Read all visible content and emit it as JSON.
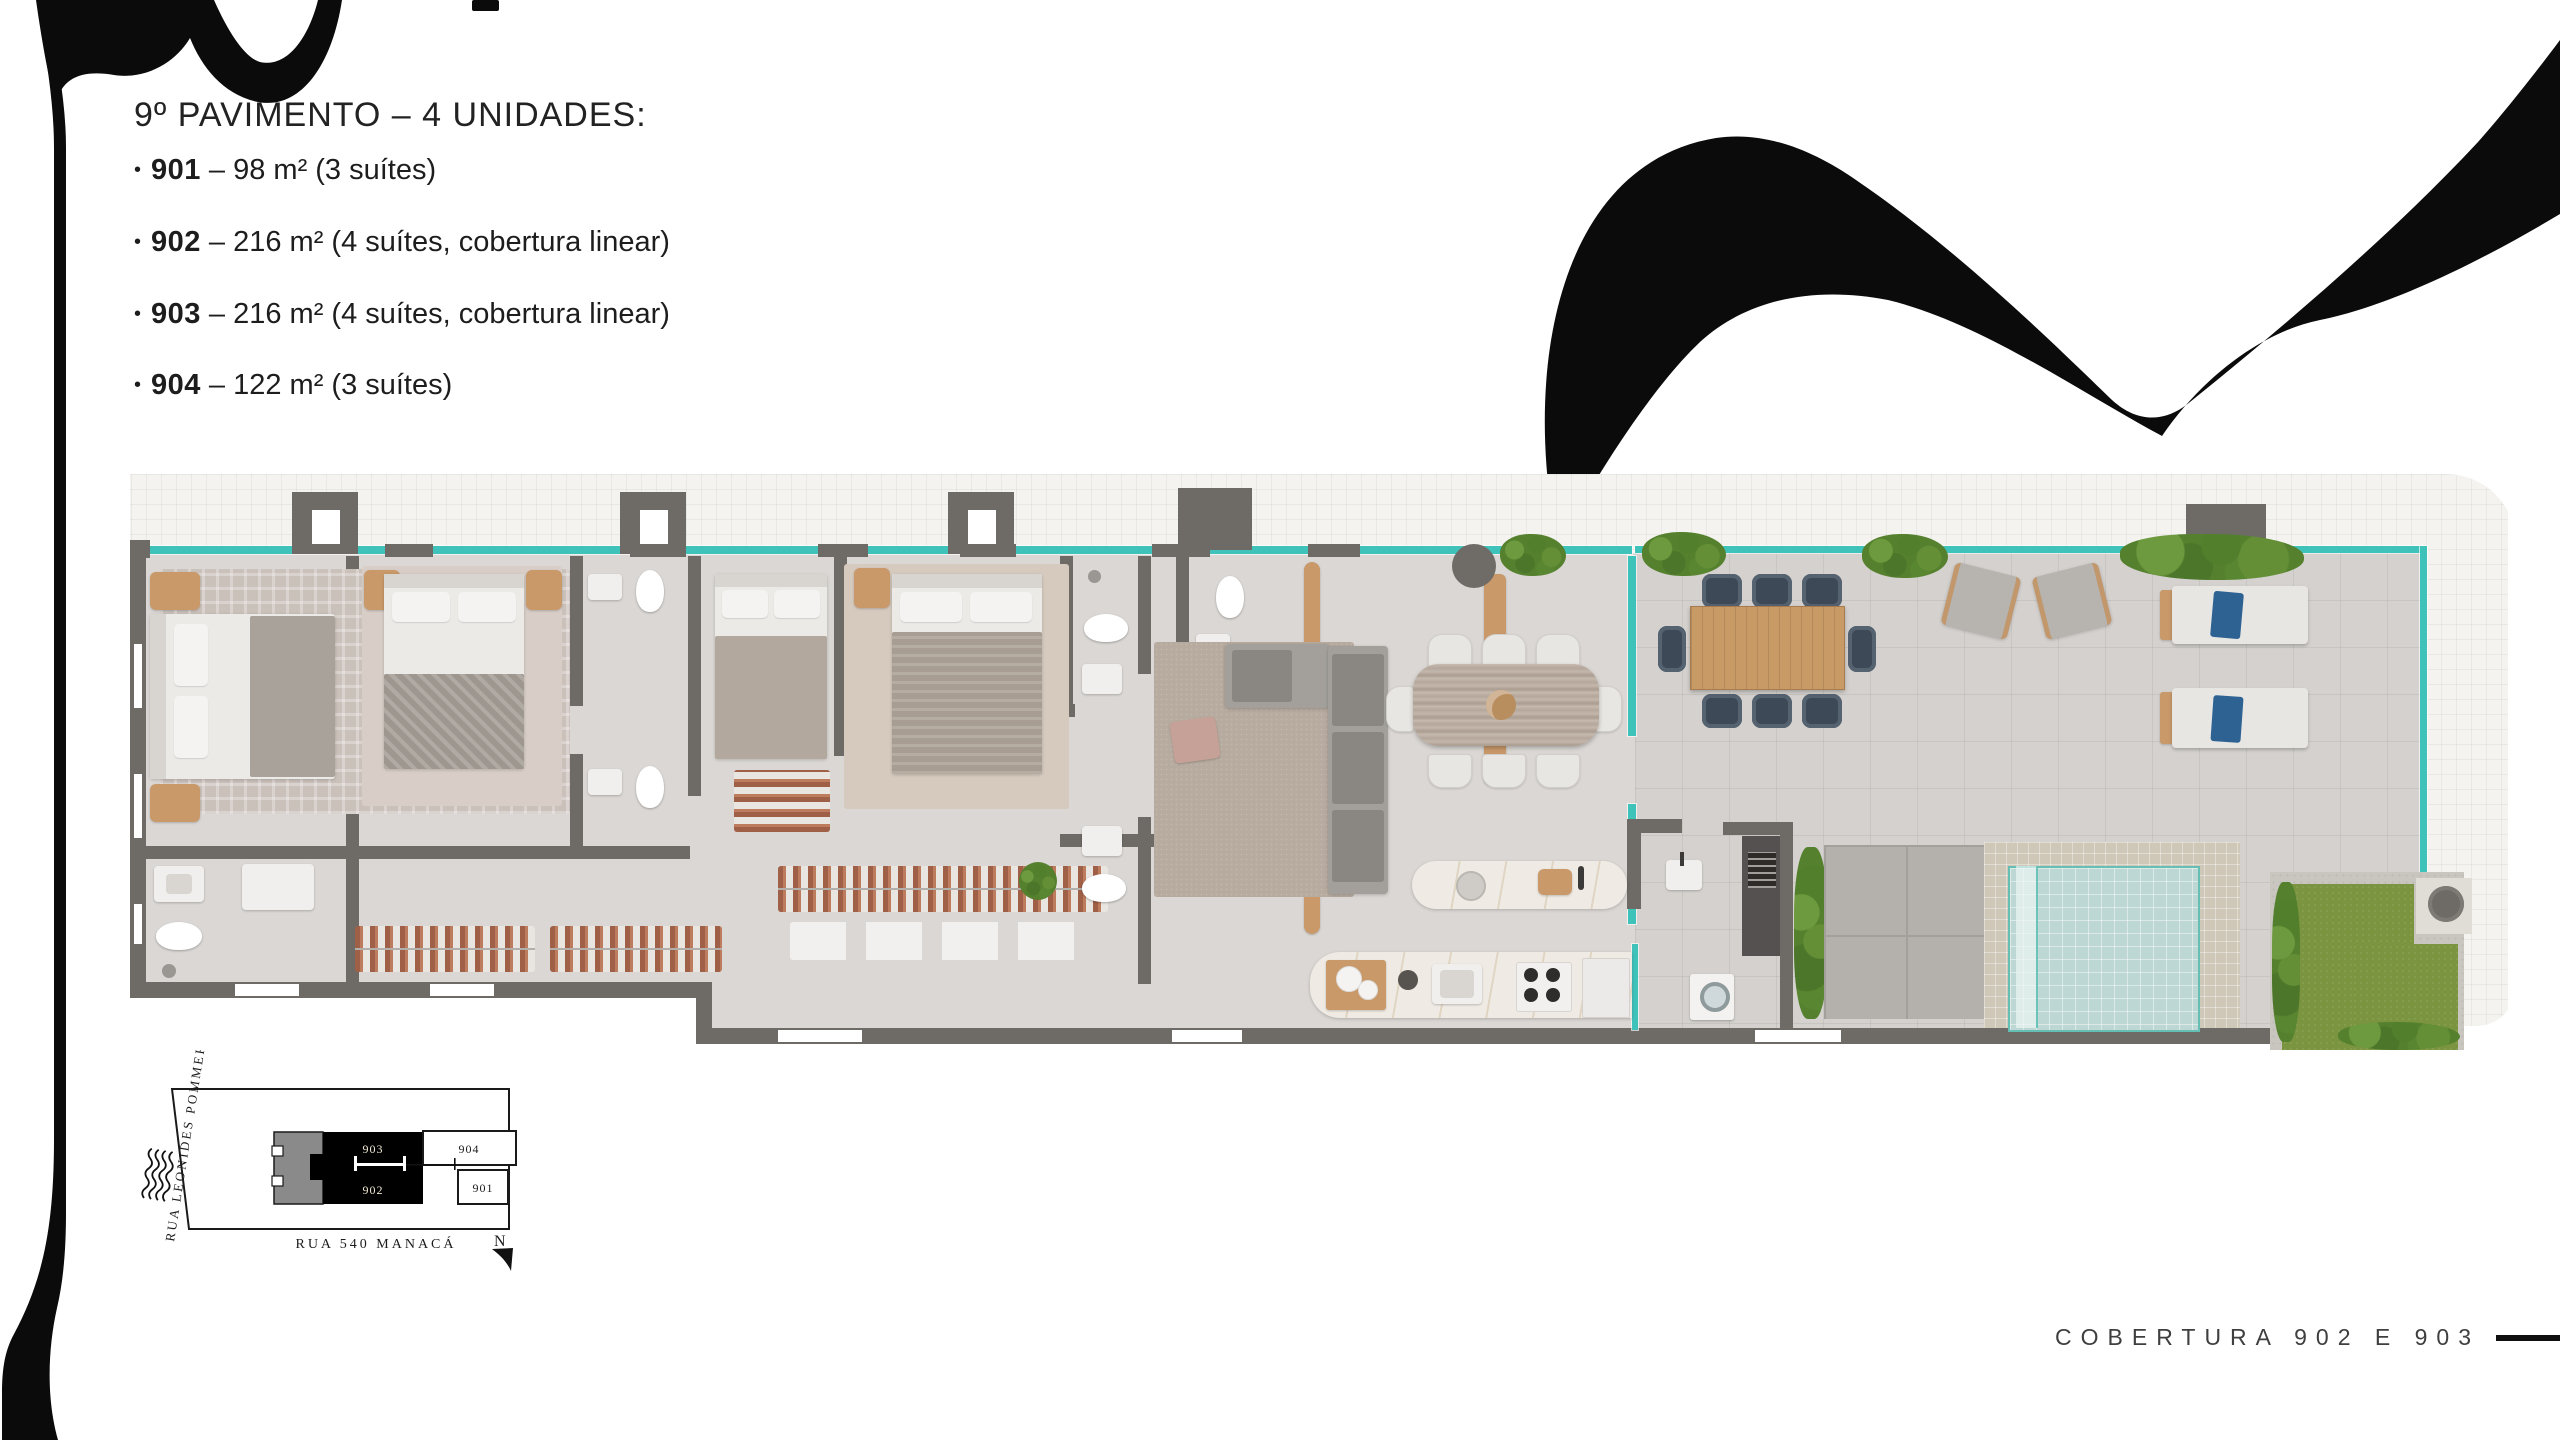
{
  "slide": {
    "title": "9º PAVIMENTO – 4 UNIDADES:",
    "bullet": "•",
    "units": [
      {
        "number": "901",
        "specs": "– 98 m² (3 suítes)"
      },
      {
        "number": "902",
        "specs": "– 216 m² (4 suítes, cobertura linear)"
      },
      {
        "number": "903",
        "specs": "– 216 m² (4 suítes, cobertura linear)"
      },
      {
        "number": "904",
        "specs": "– 122 m² (3 suítes)"
      }
    ],
    "footer_label": "COBERTURA 902 E 903"
  },
  "site_map": {
    "street_left": "RUA LEONIDES POMMER",
    "street_bottom": "RUA 540 MANACÁ",
    "north": "N",
    "units": {
      "black_top": "903",
      "black_bottom": "902",
      "white_top": "904",
      "white_bottom": "901"
    }
  },
  "colors": {
    "ink": "#0d0d0d",
    "wall_gray": "#6e6a66",
    "floor_gray": "#dad7d4",
    "glass_teal": "#3fc2ba",
    "wood": "#c9996a",
    "pool_blue": "#bdd8d4",
    "grass_green": "#7b943f",
    "hedge_green": "#55812e",
    "paper": "#f4f3f0"
  }
}
